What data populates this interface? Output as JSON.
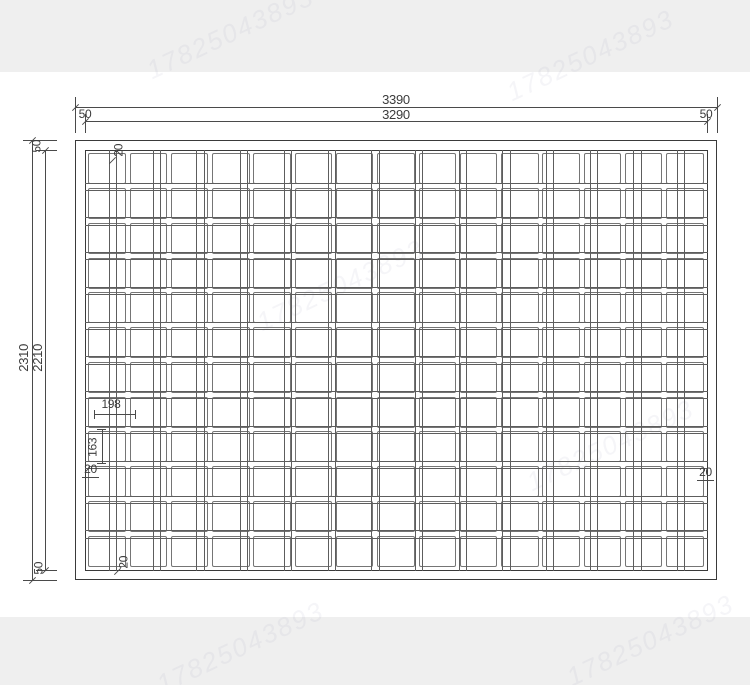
{
  "drawing": {
    "panel": {
      "grid": {
        "columns": 15,
        "rows": 12,
        "vertical_wire_pairs": 14,
        "horizontal_wire_pairs": 11
      }
    },
    "dimensions": {
      "total_width": "3390",
      "inner_width": "3290",
      "total_height": "2310",
      "inner_height": "2210",
      "frame_left": "50",
      "frame_right": "50",
      "frame_top": "50",
      "frame_bottom": "50",
      "cell_width": "198",
      "cell_height": "163",
      "gap_top": "20",
      "gap_left": "20",
      "gap_right": "20",
      "gap_bottom": "20"
    },
    "colors": {
      "background": "#ffffff",
      "band": "#efefef",
      "line": "#4a4a4a",
      "cell_border": "#757575",
      "wire": "#5d5d5d"
    },
    "watermark": "17825043893"
  }
}
